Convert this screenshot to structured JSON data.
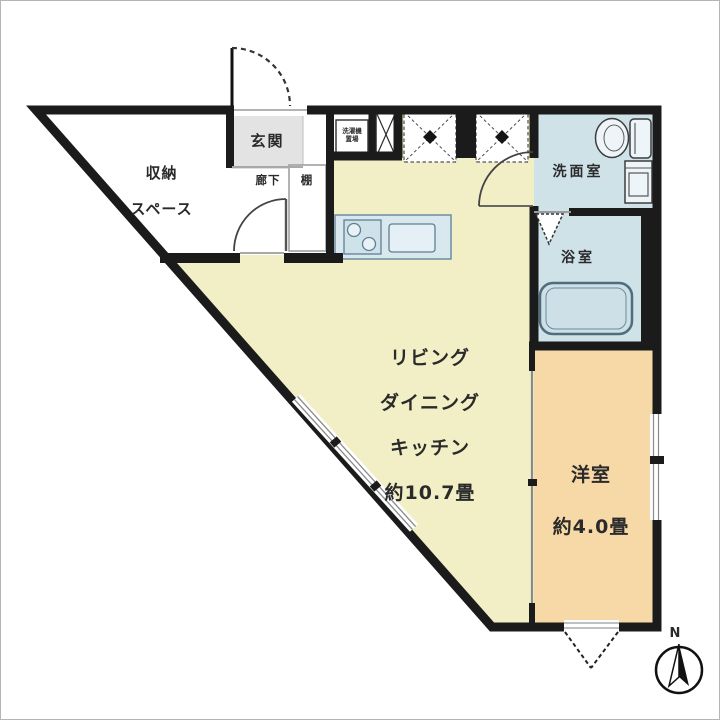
{
  "floorplan": {
    "rooms": {
      "storage": {
        "lines": [
          "収納",
          "スペース"
        ]
      },
      "entrance": {
        "label": "玄関"
      },
      "hallway": {
        "label": "廊下"
      },
      "shelf": {
        "label": "棚"
      },
      "laundry": {
        "label": "洗濯機置場"
      },
      "washroom": {
        "label": "洗面室"
      },
      "bathroom": {
        "label": "浴室"
      },
      "ldk": {
        "lines": [
          "リビング",
          "ダイニング",
          "キッチン",
          "約10.7畳"
        ],
        "size_tatami": 10.7
      },
      "western_room": {
        "lines": [
          "洋室",
          "約4.0畳"
        ],
        "size_tatami": 4.0
      }
    },
    "compass": {
      "north": "N"
    },
    "colors": {
      "wall": "#1b1b1b",
      "ldk_fill": "#f2efc6",
      "western_room_fill": "#f6d9a6",
      "wet_area_fill": "#cfe2e8",
      "entrance_fill": "#e3e3e3",
      "fixture_fill": "#eef5f8",
      "counter_fill": "#d9e8ee"
    }
  }
}
